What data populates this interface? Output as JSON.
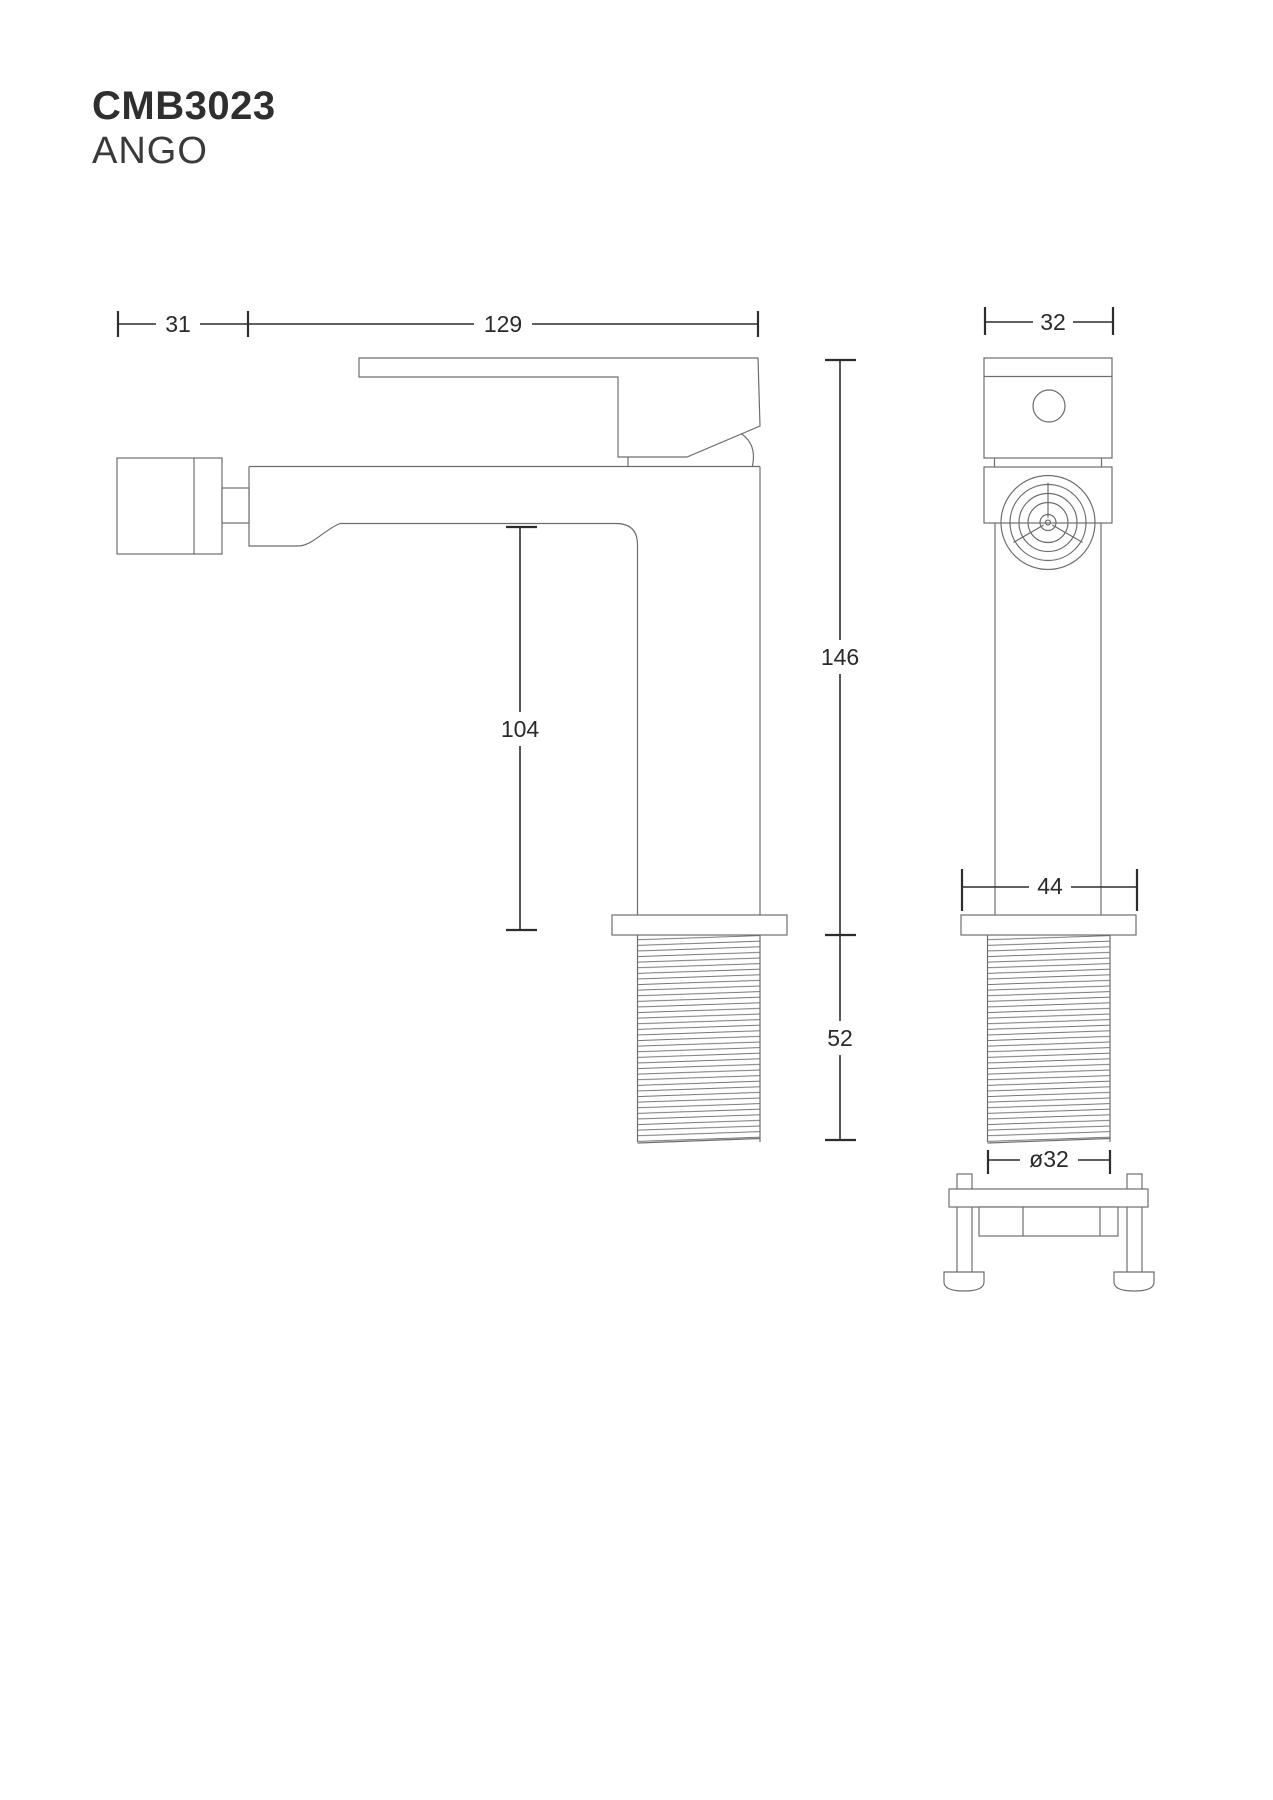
{
  "header": {
    "model": "CMB3023",
    "series": "ANGO"
  },
  "drawing": {
    "colors": {
      "outline": "#6e6e6e",
      "dimension": "#2d2d2d",
      "text": "#2a2a2a",
      "background": "#ffffff"
    },
    "side_view": {
      "dim_handle_offset": "31",
      "dim_spout_reach": "129",
      "dim_spout_height": "104",
      "dim_total_height": "146",
      "dim_thread_length": "52"
    },
    "front_view": {
      "dim_body_width": "32",
      "dim_flange_width": "44",
      "dim_thread_diameter": "ø32"
    }
  }
}
